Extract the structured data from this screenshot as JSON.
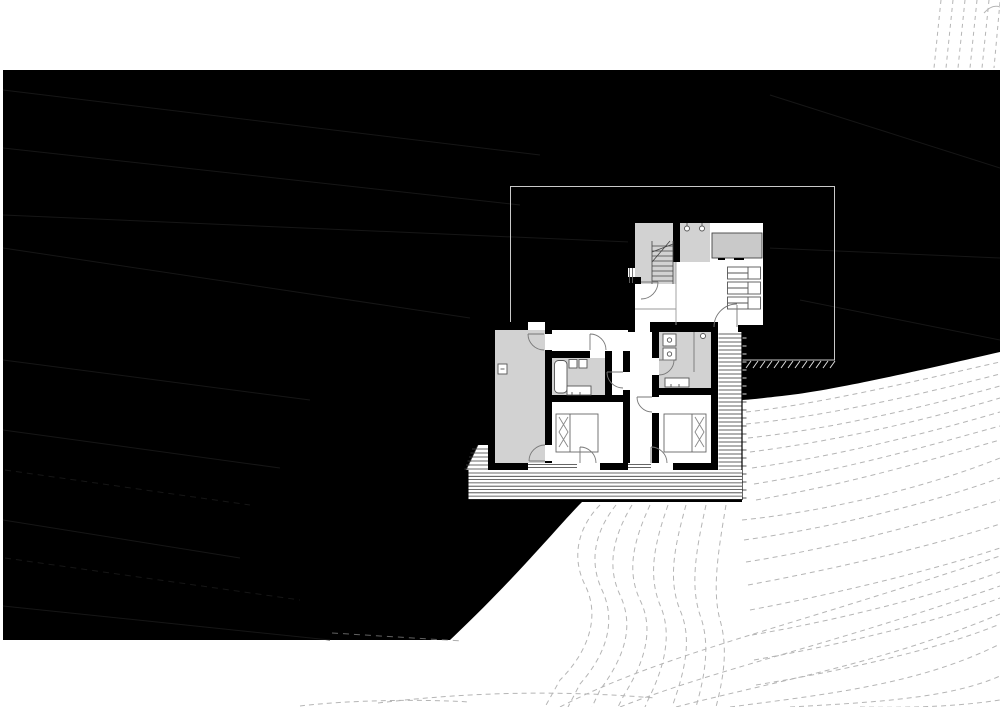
{
  "meta": {
    "drawing_title": "hillside-house-site-and-floor-plan",
    "drawing_type": "architectural plan, white line-work on black site mass with dashed terrain contours",
    "canvas": {
      "width": 1000,
      "height": 707
    }
  },
  "colors": {
    "paper": "#ffffff",
    "site_mass": "#000000",
    "wall": "#000000",
    "room_floor_gray": "#d2d2d2",
    "furniture_gray": "#c9c9c9",
    "fixture_stroke": "#555555",
    "door_arc": "#777777",
    "deck_line": "#3a3a3a",
    "tread_line": "#2e2e2e",
    "contour": "#b5b5b5",
    "contour_on_black": "#161616",
    "contour_ghost": "#8a8a8a",
    "roof_outline": "#c9c9c9",
    "tick_light": "#dddddd",
    "tick_dark": "#555555",
    "thin_partition": "#999999"
  },
  "site": {
    "mass_label": "black hillside mass",
    "terrain_label": "dashed slope contours",
    "corner_contours_top_right": 6,
    "roof_overhang_outline": {
      "x": 510,
      "y": 186,
      "w": 325,
      "h": 174
    },
    "retaining_tick_count": 13
  },
  "plan": {
    "upper_level": {
      "rooms": [
        {
          "name": "vestibule",
          "floor": "gray"
        },
        {
          "name": "staircase",
          "treads": 8
        },
        {
          "name": "entry-hall",
          "floor": "gray"
        },
        {
          "name": "living-room",
          "floor": "white"
        }
      ],
      "fixtures": [
        {
          "name": "coat-hooks",
          "count": 2
        },
        {
          "name": "wardrobe-unit",
          "floor": "gray"
        },
        {
          "name": "shelving-units",
          "count": 3
        },
        {
          "name": "entry-door",
          "type": "swing"
        }
      ]
    },
    "lower_level": {
      "rooms": [
        {
          "name": "utility-room",
          "floor": "gray"
        },
        {
          "name": "hallway",
          "floor": "white"
        },
        {
          "name": "corridor",
          "floor": "white"
        },
        {
          "name": "bathroom",
          "floor": "gray",
          "fixtures": [
            "bathtub",
            "double-basin",
            "wc-pair"
          ]
        },
        {
          "name": "wc-laundry",
          "floor": "gray",
          "fixtures": [
            "washer-dryer-stack",
            "basin",
            "ceiling-light"
          ]
        },
        {
          "name": "bedroom-1",
          "fixtures": [
            "double-bed"
          ]
        },
        {
          "name": "bedroom-2",
          "fixtures": [
            "double-bed"
          ]
        }
      ],
      "windows": 3,
      "doors": 9
    },
    "exterior": {
      "deck_boards": 9,
      "side_steps": 6,
      "hillside_stair_treads": 44
    }
  }
}
